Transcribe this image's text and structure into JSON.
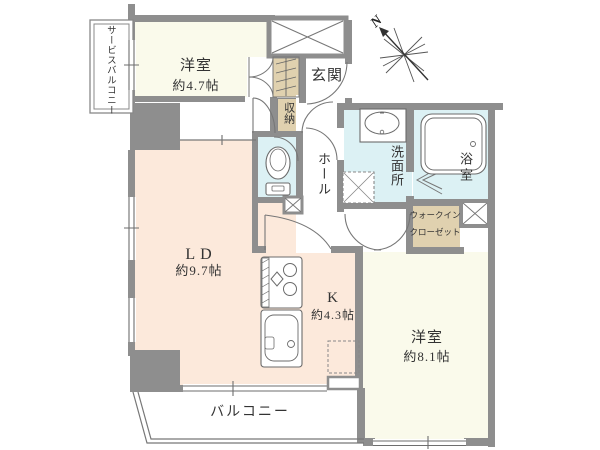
{
  "plan_title": "apartment-floor-plan",
  "rooms": {
    "service_balcony": {
      "label": "サービスバルコニー"
    },
    "bedroom_47": {
      "label": "洋室",
      "size": "約4.7帖"
    },
    "entrance": {
      "label": "玄関"
    },
    "storage": {
      "label": "収納"
    },
    "hall": {
      "label": "ホール"
    },
    "washroom": {
      "label": "洗面所"
    },
    "bathroom": {
      "label": "浴室"
    },
    "walk_in_closet": {
      "label_line1": "ウォークイン",
      "label_line2": "クローゼット"
    },
    "living_dining": {
      "label": "LD",
      "size": "約9.7帖"
    },
    "kitchen": {
      "label": "K",
      "size": "約4.3帖"
    },
    "bedroom_81": {
      "label": "洋室",
      "size": "約8.1帖"
    },
    "balcony": {
      "label": "バルコニー"
    }
  },
  "compass": {
    "label": "N"
  },
  "colors": {
    "wall": "#8e8e8e",
    "room_ivory": "#fafaeb",
    "room_peach": "#fce9db",
    "room_cyan": "#dcf1f4",
    "closet_tan": "#e0d1af",
    "line": "#6e6e6e",
    "text": "#333333"
  }
}
